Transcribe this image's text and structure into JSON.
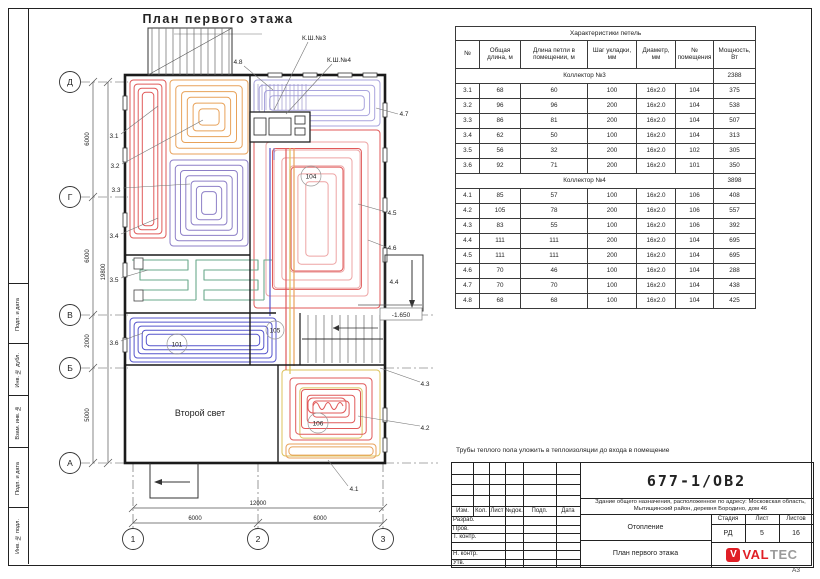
{
  "sheet": {
    "format_label": "А3"
  },
  "frame": {
    "side_labels": [
      "Подп. и дата",
      "Инв. № дубл.",
      "Взам. инв. №",
      "Подп. и дата",
      "Инв. № подл."
    ]
  },
  "plan": {
    "title": "План первого этажа",
    "row_axes": [
      "Д",
      "Г",
      "В",
      "Б",
      "А"
    ],
    "col_axes": [
      "1",
      "2",
      "3"
    ],
    "dims_left": [
      "6000",
      "6000",
      "2000",
      "5000"
    ],
    "dim_left_total": "19800",
    "dims_bottom": [
      "6000",
      "6000"
    ],
    "dim_bottom_total": "12000",
    "elevation": "-1.650",
    "second_light": "Второй свет",
    "cabinet_labels": [
      "К.Ш.№3",
      "К.Ш.№4"
    ],
    "loop_labels_left": [
      "3.1",
      "3.2",
      "3.3",
      "3.4",
      "3.5",
      "3.6"
    ],
    "loop_labels_right": [
      "4.7",
      "4.5",
      "4.6",
      "4.4",
      "4.3",
      "4.2"
    ],
    "loop_label_top": "4.8",
    "loop_label_bottom": "4.1",
    "room_numbers": {
      "big": "104",
      "blue": "101",
      "stairs": "105",
      "br": "106"
    }
  },
  "table": {
    "title": "Характеристики петель",
    "headers": [
      "№",
      "Общая длина, м",
      "Длина петли в помещении, м",
      "Шаг укладки, мм",
      "Диаметр, мм",
      "№ помещения",
      "Мощность, Вт"
    ],
    "groups": [
      {
        "name": "Коллектор №3",
        "total": "2388",
        "rows": [
          [
            "3.1",
            "68",
            "60",
            "100",
            "16x2.0",
            "104",
            "375"
          ],
          [
            "3.2",
            "96",
            "96",
            "200",
            "16x2.0",
            "104",
            "538"
          ],
          [
            "3.3",
            "86",
            "81",
            "200",
            "16x2.0",
            "104",
            "507"
          ],
          [
            "3.4",
            "62",
            "50",
            "100",
            "16x2.0",
            "104",
            "313"
          ],
          [
            "3.5",
            "56",
            "32",
            "200",
            "16x2.0",
            "102",
            "305"
          ],
          [
            "3.6",
            "92",
            "71",
            "200",
            "16x2.0",
            "101",
            "350"
          ]
        ]
      },
      {
        "name": "Коллектор №4",
        "total": "3898",
        "rows": [
          [
            "4.1",
            "85",
            "57",
            "100",
            "16x2.0",
            "106",
            "408"
          ],
          [
            "4.2",
            "105",
            "78",
            "200",
            "16x2.0",
            "106",
            "557"
          ],
          [
            "4.3",
            "83",
            "55",
            "100",
            "16x2.0",
            "106",
            "392"
          ],
          [
            "4.4",
            "111",
            "111",
            "200",
            "16x2.0",
            "104",
            "695"
          ],
          [
            "4.5",
            "111",
            "111",
            "200",
            "16x2.0",
            "104",
            "695"
          ],
          [
            "4.6",
            "70",
            "46",
            "100",
            "16x2.0",
            "104",
            "288"
          ],
          [
            "4.7",
            "70",
            "70",
            "100",
            "16x2.0",
            "104",
            "438"
          ],
          [
            "4.8",
            "68",
            "68",
            "100",
            "16x2.0",
            "104",
            "425"
          ]
        ]
      }
    ]
  },
  "note": "Трубы теплого пола уложить в теплоизоляции до входа в помещение",
  "title_block": {
    "doc_number": "677-1/ОВ2",
    "object_description": "Здание общего назначения, расположенное по адресу: Московская область, Мытищинский район, деревня Бородино, дом 46",
    "section_title": "Отопление",
    "sheet_title": "План первого этажа",
    "header_cells": [
      "Изм.",
      "Кол.",
      "Лист",
      "№док.",
      "Подп.",
      "Дата"
    ],
    "signature_rows": [
      "Разраб.",
      "Пров.",
      "Т. контр.",
      "",
      "Н. контр.",
      "Утв."
    ],
    "stage_label": "Стадия",
    "sheet_label": "Лист",
    "sheets_label": "Листов",
    "stage": "РД",
    "sheet_no": "5",
    "sheets_total": "16",
    "logo": {
      "v": "V",
      "val": "VAL",
      "tec": "TEC"
    }
  },
  "colors": {
    "red": "#e05a5a",
    "orange": "#e8a25a",
    "yellow": "#dcc35c",
    "purple": "#8d7fc7",
    "lavender": "#a9a4dd",
    "pink": "#eda4a4",
    "blue": "#5555cc",
    "green": "#6aa98b",
    "brand_red": "#e01f26",
    "brand_gray": "#9b9b9b",
    "hatch": "#666",
    "pipes": "#9a96cc"
  }
}
